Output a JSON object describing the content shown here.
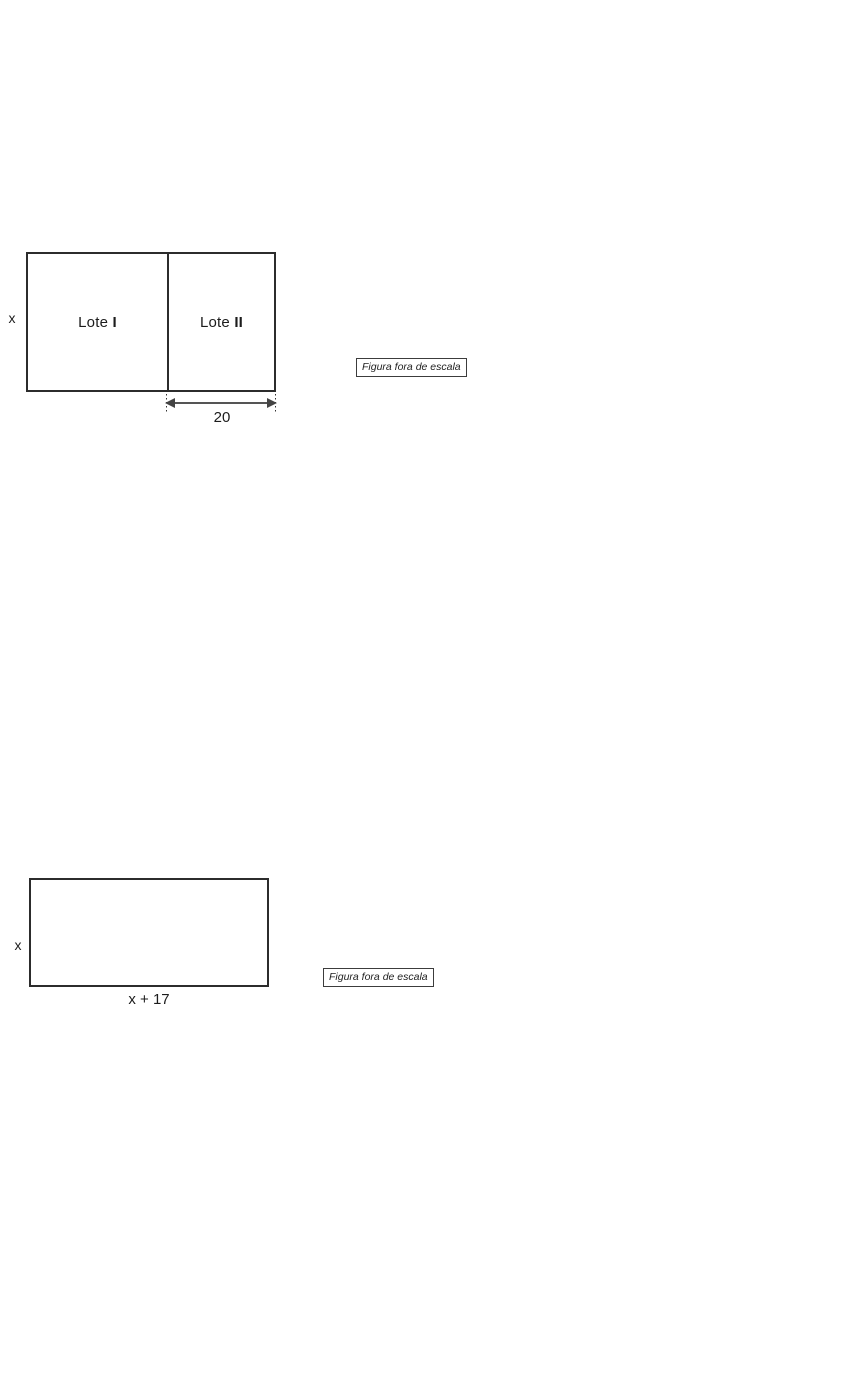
{
  "figure1": {
    "height_label": "x",
    "lots": [
      {
        "word": "Lote",
        "numeral": "I"
      },
      {
        "word": "Lote",
        "numeral": "II"
      }
    ],
    "dimension_label": "20",
    "scale_note": "Figura fora de escala"
  },
  "figure2": {
    "height_label": "x",
    "width_label": "x + 17",
    "scale_note": "Figura fora de escala"
  },
  "colors": {
    "background": "#ffffff",
    "shape_line": "#2c2c2c",
    "arrow_line": "#555555",
    "text": "#1c1c1c"
  }
}
